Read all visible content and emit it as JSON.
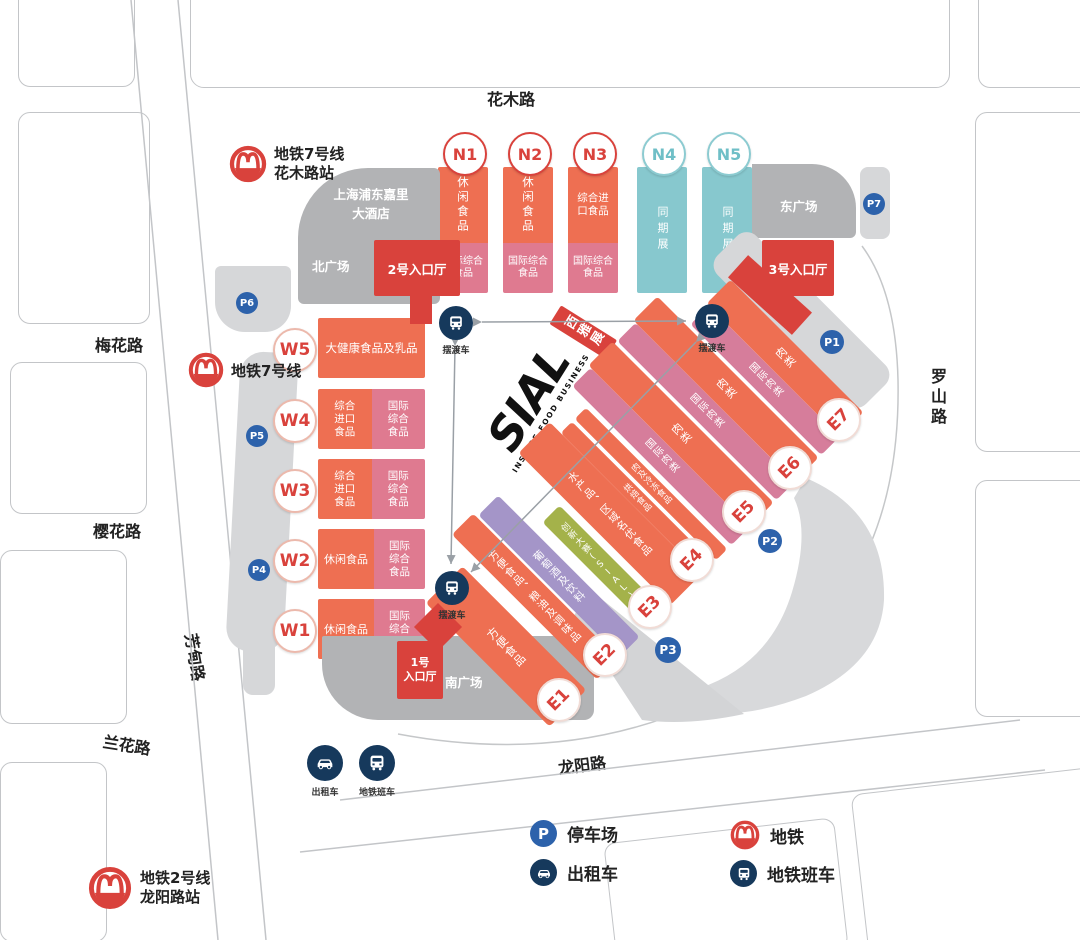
{
  "colors": {
    "hall_orange": "#ee6f52",
    "hall_pink": "#df7a90",
    "hall_mauve": "#d67d9b",
    "hall_teal": "#87c8ce",
    "entrance_red": "#d9423c",
    "hall_green": "#a4b24a",
    "hall_purple": "#a495c8",
    "parking_blue": "#2d62ab",
    "icon_navy": "#16395c",
    "plaza_gray": "#b2b3b5",
    "parking_gray": "#d6d7d9"
  },
  "roads": {
    "huamu": "花木路",
    "meihua": "梅花路",
    "yinghua": "樱花路",
    "fangdian": "芳甸路",
    "lanhua": "兰花路",
    "luoshan": "罗山路",
    "longyang": "龙阳路"
  },
  "metro": {
    "line7_station": {
      "l1": "地铁7号线",
      "l2": "花木路站"
    },
    "line7": {
      "l1": "地铁7号线"
    },
    "line2_station": {
      "l1": "地铁2号线",
      "l2": "龙阳路站"
    }
  },
  "plazas": {
    "north": "北广场",
    "east": "东广场",
    "south": "南广场"
  },
  "hotel": {
    "l1": "上海浦东嘉里",
    "l2": "大酒店"
  },
  "entrances": {
    "no1_l1": "1号",
    "no1_l2": "入口厅",
    "no2": "2号入口厅",
    "no3": "3号入口厅"
  },
  "halls_n": [
    {
      "id": "N1",
      "top": "休闲食品",
      "bottom": "国际综合食品"
    },
    {
      "id": "N2",
      "top": "休闲食品",
      "bottom": "国际综合食品"
    },
    {
      "id": "N3",
      "top": "综合进口食品",
      "bottom": "国际综合食品"
    },
    {
      "id": "N4",
      "zone": "同期展"
    },
    {
      "id": "N5",
      "zone": "同期展"
    }
  ],
  "halls_w": [
    {
      "id": "W5",
      "zone": "大健康食品及乳品"
    },
    {
      "id": "W4",
      "left": "综合进口食品",
      "right": "国际综合食品"
    },
    {
      "id": "W3",
      "left": "综合进口食品",
      "right": "国际综合食品"
    },
    {
      "id": "W2",
      "left": "休闲食品",
      "right": "国际综合食品"
    },
    {
      "id": "W1",
      "left": "休闲食品",
      "right": "国际综合食品"
    }
  ],
  "halls_e": [
    {
      "id": "E1",
      "strips": [
        {
          "label": "方便食品"
        }
      ]
    },
    {
      "id": "E2",
      "strips": [
        {
          "label": "方便食品、粮油及调味品"
        },
        {
          "label": "葡萄酒及饮料"
        }
      ]
    },
    {
      "id": "E3",
      "strips": [
        {
          "label": "创新大赛(SIAL)"
        }
      ],
      "star": "★"
    },
    {
      "id": "E4",
      "strips": [
        {
          "label": "水产品、区域名优食品"
        },
        {
          "label": "烘焙食品"
        },
        {
          "label": "肉及冷冻食品"
        }
      ]
    },
    {
      "id": "E5",
      "strips": [
        {
          "label": "国际肉类"
        },
        {
          "label": "肉类"
        }
      ]
    },
    {
      "id": "E6",
      "strips": [
        {
          "label": "国际肉类"
        },
        {
          "label": "肉类"
        }
      ]
    },
    {
      "id": "E7",
      "strips": [
        {
          "label": "国际肉类"
        },
        {
          "label": "肉类"
        }
      ]
    }
  ],
  "parking": {
    "p1": "P1",
    "p2": "P2",
    "p3": "P3",
    "p4": "P4",
    "p5": "P5",
    "p6": "P6",
    "p7": "P7"
  },
  "shuttle_stop": "摆渡车",
  "logo": {
    "name": "SIAL",
    "tagline": "INSPIRE FOOD BUSINESS",
    "tag": "西雅展"
  },
  "legend": {
    "parking": "停车场",
    "taxi": "出租车",
    "metro": "地铁",
    "metro_shuttle": "地铁班车"
  },
  "south_transport": {
    "taxi": "出租车",
    "shuttle": "地铁班车"
  }
}
